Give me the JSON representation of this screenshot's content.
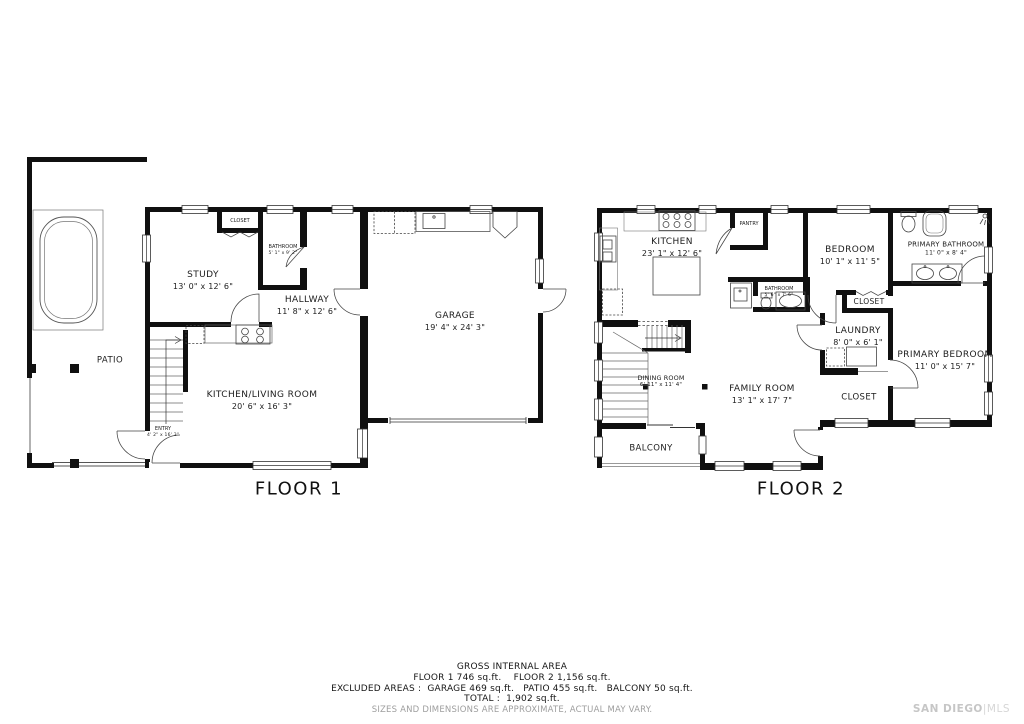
{
  "floor1": {
    "label": "FLOOR 1",
    "rooms": {
      "patio": {
        "name": "PATIO"
      },
      "study": {
        "name": "STUDY",
        "dims": "13' 0\" x 12' 6\""
      },
      "closet": {
        "name": "CLOSET"
      },
      "bathroom": {
        "name": "BATHROOM",
        "dims": "5' 1\" x 9' 2\""
      },
      "hallway": {
        "name": "HALLWAY",
        "dims": "11' 8\" x 12' 6\""
      },
      "garage": {
        "name": "GARAGE",
        "dims": "19' 4\" x 24' 3\""
      },
      "kitchen_living": {
        "name": "KITCHEN/LIVING ROOM",
        "dims": "20' 6\" x 16' 3\""
      },
      "entry": {
        "name": "ENTRY",
        "dims": "4' 2\" x 16' 3\""
      }
    }
  },
  "floor2": {
    "label": "FLOOR 2",
    "rooms": {
      "kitchen": {
        "name": "KITCHEN",
        "dims": "23' 1\" x 12' 6\""
      },
      "pantry": {
        "name": "PANTRY"
      },
      "bathroom": {
        "name": "BATHROOM",
        "dims": "5' 6\" x 7' 6\""
      },
      "bedroom": {
        "name": "BEDROOM",
        "dims": "10' 1\" x 11' 5\""
      },
      "primary_bathroom": {
        "name": "PRIMARY BATHROOM",
        "dims": "11' 0\" x 8' 4\""
      },
      "closet_bedroom": {
        "name": "CLOSET"
      },
      "laundry": {
        "name": "LAUNDRY",
        "dims": "8' 0\" x 6' 1\""
      },
      "primary_bedroom": {
        "name": "PRIMARY BEDROOM",
        "dims": "11' 0\" x 15' 7\""
      },
      "closet_primary": {
        "name": "CLOSET"
      },
      "family_room": {
        "name": "FAMILY ROOM",
        "dims": "13' 1\" x 17' 7\""
      },
      "dining_room": {
        "name": "DINING ROOM",
        "dims": "6' 11\" x 11' 4\""
      },
      "balcony": {
        "name": "BALCONY"
      }
    }
  },
  "summary": {
    "title": "GROSS INTERNAL AREA",
    "line1": "FLOOR 1 746 sq.ft.    FLOOR 2 1,156 sq.ft.",
    "line2": "EXCLUDED AREAS :  GARAGE 469 sq.ft.   PATIO 455 sq.ft.   BALCONY 50 sq.ft.",
    "line3": "TOTAL :  1,902 sq.ft.",
    "disclaimer": "SIZES AND DIMENSIONS ARE APPROXIMATE, ACTUAL MAY VARY."
  },
  "watermark": {
    "name": "SAN DIEGO",
    "divider": "|",
    "org": "MLS"
  }
}
